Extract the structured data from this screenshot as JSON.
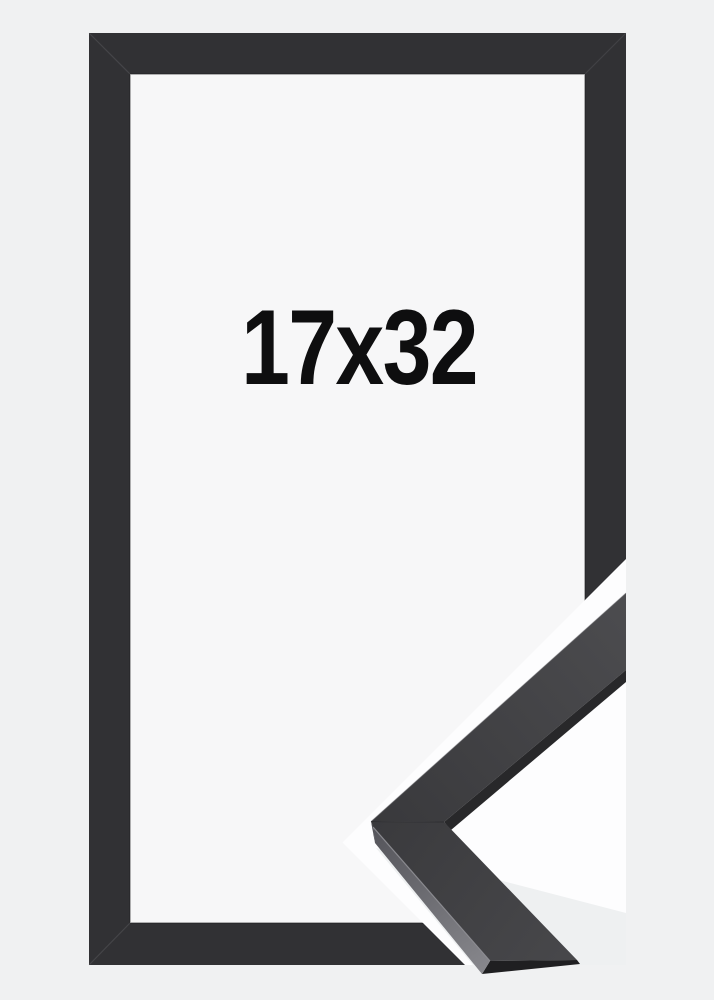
{
  "image": {
    "type": "product-photo-frame",
    "size_label": "17x32"
  },
  "colors": {
    "background": "#f0f1f2",
    "frame_border": "#313134",
    "inner_area": "#f7f7f8",
    "gap_white": "#fdfdfe",
    "under_moulding_shadow": "#eef0f1",
    "moulding_inner_side": "#28282a",
    "moulding_end_face": "#1f1f21",
    "label_text": "#0e0e0f"
  }
}
